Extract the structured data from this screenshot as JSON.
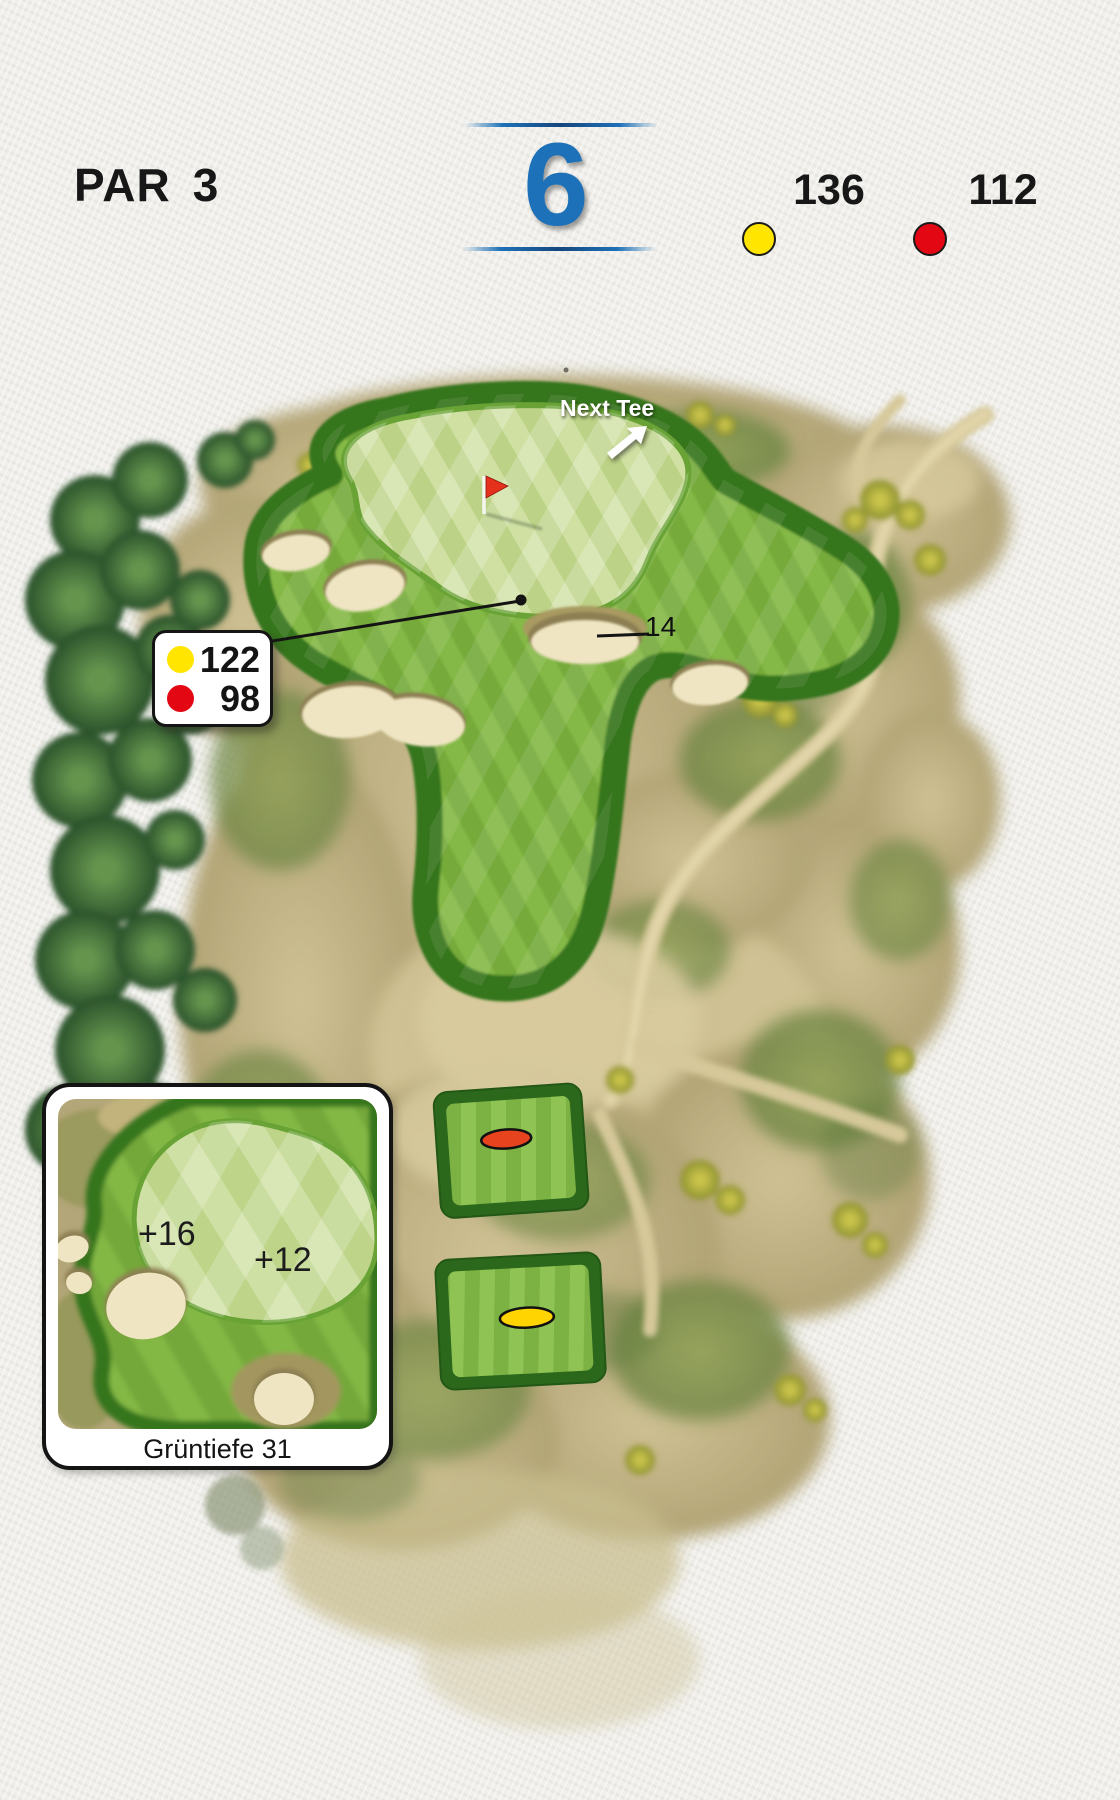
{
  "header": {
    "par_label": "PAR",
    "par_value": "3",
    "hole_number": "6",
    "yellow_tee": {
      "color": "#ffe500",
      "distance": "136"
    },
    "red_tee": {
      "color": "#e30613",
      "distance": "112"
    }
  },
  "course_map": {
    "next_tee_label": "Next Tee",
    "pin_distance_callout": {
      "yellow": "122",
      "red": "98"
    },
    "bunker_carry_label": "14",
    "inset": {
      "front_plus_value": "+16",
      "back_plus_value": "+12",
      "caption": "Grüntiefe 31"
    }
  },
  "icons": {
    "flag": "flag-icon",
    "next_tee_arrow": "arrow-up-right-icon"
  },
  "colors": {
    "accent_blue": "#1d71b8",
    "yellow_marker": "#ffe500",
    "red_marker": "#e30613",
    "green_putting": "#c5d998",
    "green_fairway": "#7eb240",
    "green_fringe": "#35741f",
    "sand_bunker": "#efe5c2",
    "rough_tan": "#bfb080"
  }
}
